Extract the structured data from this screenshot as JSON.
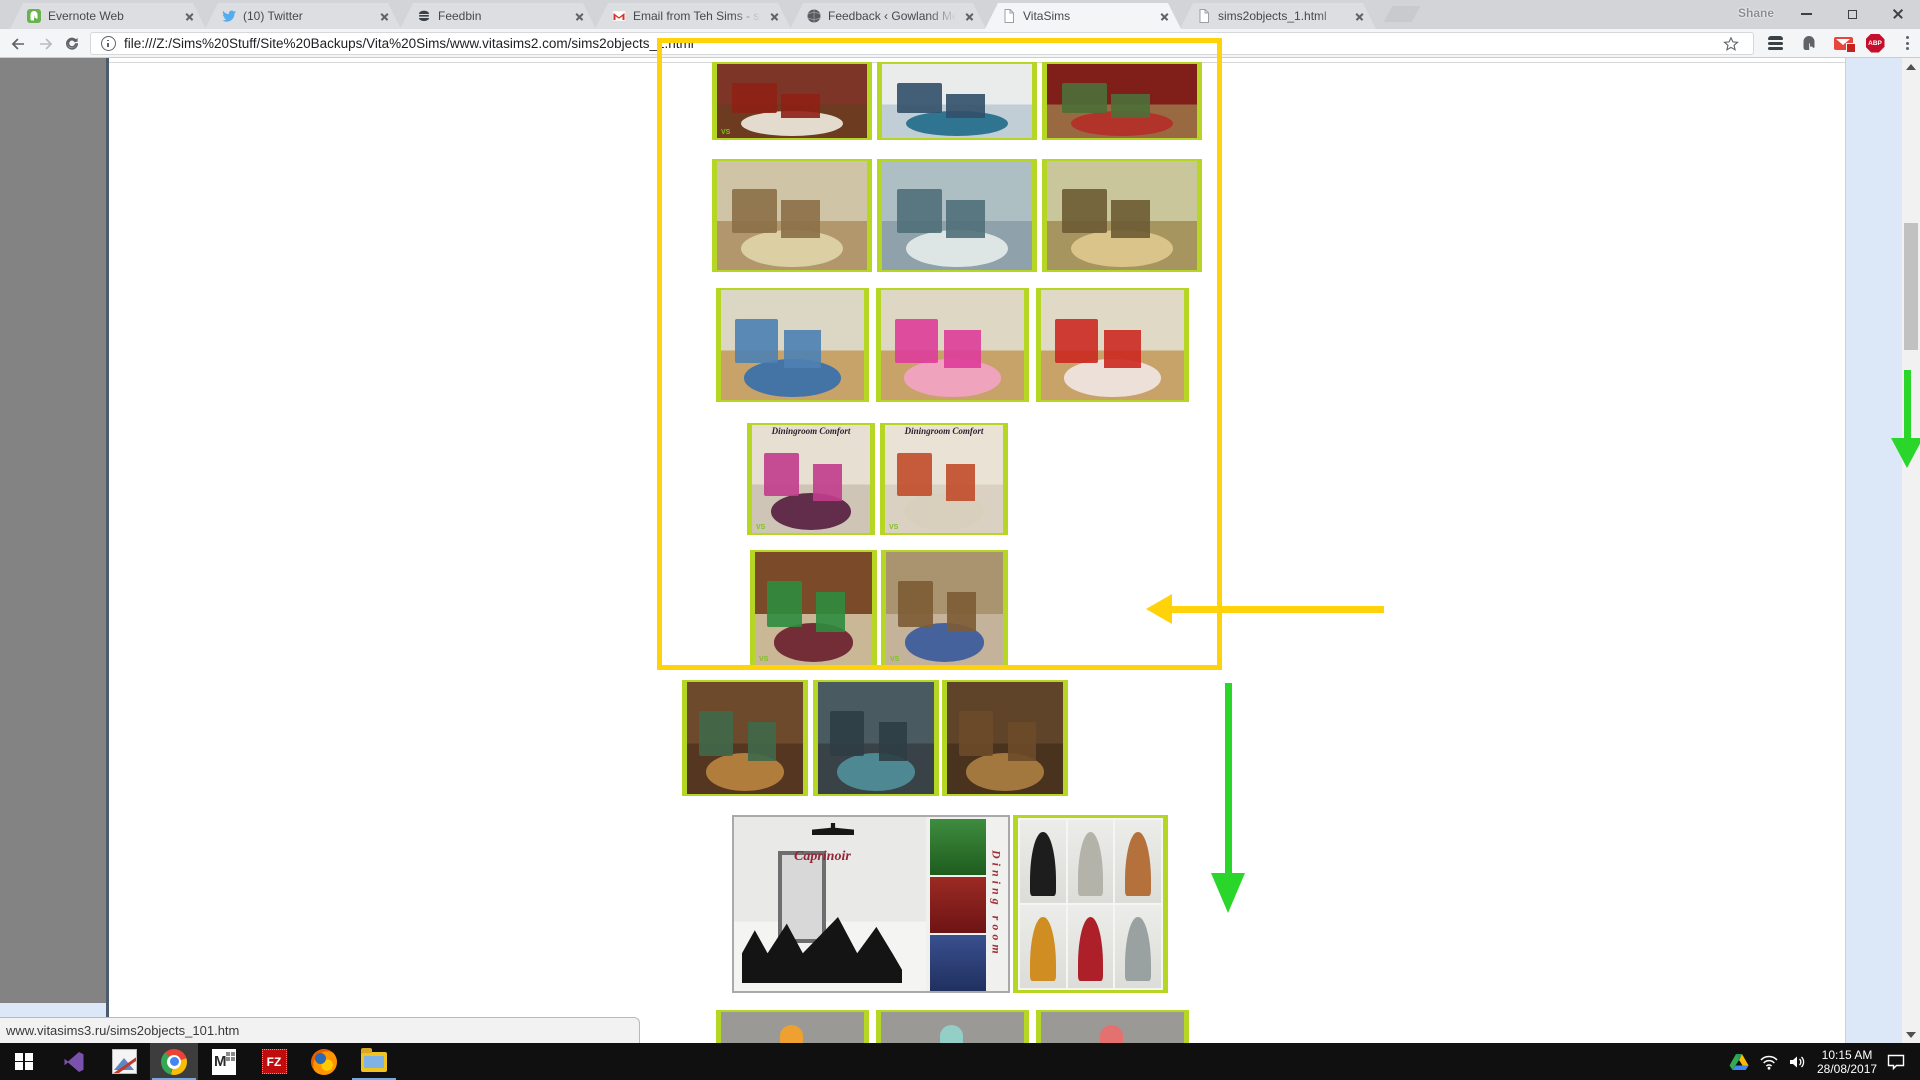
{
  "chrome": {
    "profile": "Shane",
    "tabs": [
      {
        "title": "Evernote Web"
      },
      {
        "title": "(10) Twitter"
      },
      {
        "title": "Feedbin"
      },
      {
        "title": "Email from Teh Sims - sha"
      },
      {
        "title": "Feedback ‹ Gowland Mec"
      },
      {
        "title": "VitaSims"
      },
      {
        "title": "sims2objects_1.html"
      }
    ],
    "url": "file:///Z:/Sims%20Stuff/Site%20Backups/Vita%20Sims/www.vitasims2.com/sims2objects_1.html",
    "extensions": {
      "abp_label": "ABP"
    }
  },
  "page": {
    "status_bar": "www.vitasims3.ru/sims2objects_101.htm",
    "watermark": "VS",
    "dining_label": "Diningroom Comfort",
    "rows": [
      {
        "name": "bedroom-row",
        "items": [
          {
            "desc": "dark red mahogany bedroom with cowhide rug",
            "palette": {
              "wall": "#7c3526",
              "floor": "#6d3b20",
              "a": "#e9e4d8",
              "b": "#8f2015"
            }
          },
          {
            "desc": "white and blue dining room",
            "palette": {
              "wall": "#e9eceb",
              "floor": "#c2ced6",
              "a": "#27708d",
              "b": "#32506b"
            }
          },
          {
            "desc": "red drawing room with plants",
            "palette": {
              "wall": "#801f1a",
              "floor": "#996a41",
              "a": "#b23029",
              "b": "#4d6f38"
            }
          }
        ]
      },
      {
        "name": "classic-living-row",
        "items": [
          {
            "desc": "beige classic living room with piano",
            "palette": {
              "wall": "#cfc5a6",
              "floor": "#b2976c",
              "a": "#ded2a8",
              "b": "#8c7048"
            }
          },
          {
            "desc": "blue-grey salon with white piano",
            "palette": {
              "wall": "#aebfc3",
              "floor": "#8fa2ab",
              "a": "#e3e9e8",
              "b": "#50707a"
            }
          },
          {
            "desc": "olive study with grandfather clock",
            "palette": {
              "wall": "#c9c69c",
              "floor": "#a6955e",
              "a": "#dcc68c",
              "b": "#6d5c34"
            }
          }
        ]
      },
      {
        "name": "kids-room-row",
        "items": [
          {
            "desc": "kids room with blue furniture",
            "palette": {
              "wall": "#dcd6c4",
              "floor": "#c8a369",
              "a": "#3d72a9",
              "b": "#4e81b4"
            }
          },
          {
            "desc": "kids room with pink furniture",
            "palette": {
              "wall": "#ded7c3",
              "floor": "#c8a369",
              "a": "#f2a3c2",
              "b": "#df3d9b"
            }
          },
          {
            "desc": "kids room with red furniture",
            "palette": {
              "wall": "#e0d9c6",
              "floor": "#c8a369",
              "a": "#efe4de",
              "b": "#cc2a22"
            }
          }
        ]
      },
      {
        "name": "diningroom-comfort-row",
        "items": [
          {
            "desc": "Diningroom Comfort pink variant",
            "palette": {
              "wall": "#e7dfd2",
              "floor": "#cfc5b6",
              "a": "#5c2544",
              "b": "#c23d8d"
            }
          },
          {
            "desc": "Diningroom Comfort red variant",
            "palette": {
              "wall": "#eae2d4",
              "floor": "#dbd1c2",
              "a": "#d8d0bd",
              "b": "#c24d2b"
            }
          }
        ]
      },
      {
        "name": "den-row",
        "items": [
          {
            "desc": "wood panelled den with burgundy chairs and aquarium",
            "palette": {
              "wall": "#7b4b29",
              "floor": "#c9b795",
              "a": "#6e2531",
              "b": "#2e8c3f"
            }
          },
          {
            "desc": "den with blue sofas and wall unit",
            "palette": {
              "wall": "#a9946f",
              "floor": "#c4b39a",
              "a": "#3f5e9d",
              "b": "#7d5c35"
            }
          }
        ]
      },
      {
        "name": "oriental-living-row",
        "items": [
          {
            "desc": "dark oriental lounge warm brown",
            "palette": {
              "wall": "#6d4a2c",
              "floor": "#553621",
              "a": "#b5823f",
              "b": "#41684a"
            }
          },
          {
            "desc": "dark oriental lounge teal",
            "palette": {
              "wall": "#4a5a61",
              "floor": "#394247",
              "a": "#4f8c97",
              "b": "#2e3e45"
            }
          },
          {
            "desc": "dark oriental lounge ornate brown",
            "palette": {
              "wall": "#604429",
              "floor": "#49331e",
              "a": "#a97c40",
              "b": "#6d4b29"
            }
          }
        ]
      },
      {
        "name": "lamp-row",
        "items": [
          {
            "desc": "ceiling with orange pendant lamp",
            "palette": {
              "wall": "#9b9995",
              "floor": "#b7b3ac",
              "a": "#f2a12b"
            }
          },
          {
            "desc": "ceiling with teal pendant lamp",
            "palette": {
              "wall": "#9b9995",
              "floor": "#b7b3ac",
              "a": "#93d2c9"
            }
          },
          {
            "desc": "ceiling with red pendant lamp",
            "palette": {
              "wall": "#9b9995",
              "floor": "#b7b3ac",
              "a": "#e96e6e"
            }
          }
        ]
      }
    ],
    "caprinoir": {
      "title": "Caprinoir",
      "vertical_label": "Dining room",
      "main_palette": {
        "wall": "#e9e9e7",
        "floor": "#f4f4f2",
        "a": "#1b1b1b",
        "b": "#9b9b9b"
      },
      "panels": [
        {
          "style": "background:linear-gradient(#3f8c3f,#1e5c1e)"
        },
        {
          "style": "background:linear-gradient(#9c2a24,#6d1414)"
        },
        {
          "style": "background:linear-gradient(#39508f,#20305f)"
        }
      ]
    },
    "fireplaces": [
      {
        "style": "background:#1d1d1d"
      },
      {
        "style": "background:#b3b3aa"
      },
      {
        "style": "background:#b5713c"
      },
      {
        "style": "background:#cf8d22"
      },
      {
        "style": "background:#ad2029"
      },
      {
        "style": "background:#9aa1a1"
      }
    ]
  },
  "annotations": {
    "yellow": "#ffd20a",
    "green": "#2ad62a",
    "note": "yellow box around top image group, yellow arrow pointing left at den row, green down arrows on scrollbar and below box"
  },
  "taskbar": {
    "clock_time": "10:15 AM",
    "clock_date": "28/08/2017"
  }
}
